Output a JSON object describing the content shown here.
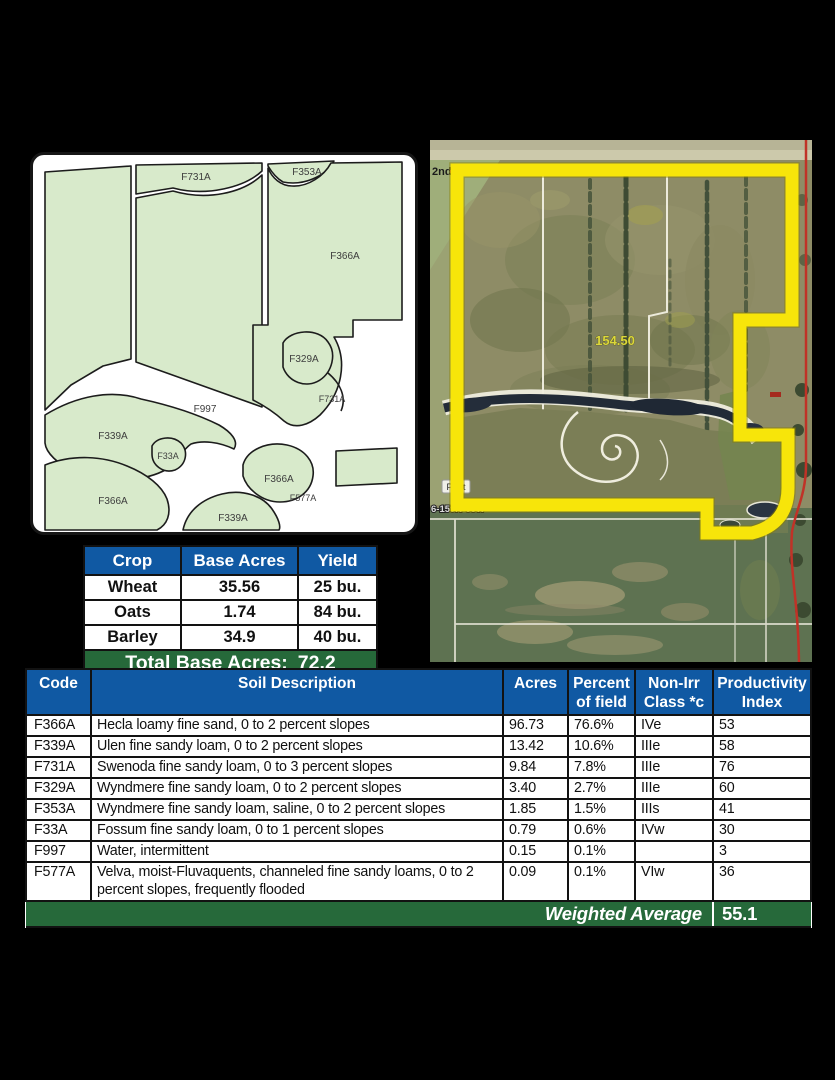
{
  "colors": {
    "header_blue": "#1059A3",
    "footer_green": "#26693A",
    "map_field_green": "#D8EACB",
    "boundary_yellow": "#F7E50A"
  },
  "soil_map": {
    "labels": [
      {
        "text": "F731A"
      },
      {
        "text": "F353A"
      },
      {
        "text": "F366A"
      },
      {
        "text": "F329A"
      },
      {
        "text": "F731A"
      },
      {
        "text": "F997"
      },
      {
        "text": "F339A"
      },
      {
        "text": "F33A"
      },
      {
        "text": "F366A"
      },
      {
        "text": "F366A"
      },
      {
        "text": "F577A"
      },
      {
        "text": "F339A"
      }
    ]
  },
  "aerial": {
    "road_label_left": "2nd",
    "road_label_right": "82nd St N",
    "acreage_label": "154.50",
    "place_label": "Pratt",
    "township_label": "6-159N-65W"
  },
  "crop_table": {
    "headers": [
      "Crop",
      "Base Acres",
      "Yield"
    ],
    "rows": [
      [
        "Wheat",
        "35.56",
        "25 bu."
      ],
      [
        "Oats",
        "1.74",
        "84 bu."
      ],
      [
        "Barley",
        "34.9",
        "40 bu."
      ]
    ],
    "total_label": "Total Base Acres:",
    "total_value": "72.2"
  },
  "soil_table": {
    "headers": [
      "Code",
      "Soil Description",
      "Acres",
      "Percent\nof field",
      "Non-Irr\nClass *c",
      "Productivity\nIndex"
    ],
    "rows": [
      [
        "F366A",
        "Hecla loamy fine sand, 0 to 2 percent slopes",
        "96.73",
        "76.6%",
        "IVe",
        "53"
      ],
      [
        "F339A",
        "Ulen fine sandy loam, 0 to 2 percent slopes",
        "13.42",
        "10.6%",
        "IIIe",
        "58"
      ],
      [
        "F731A",
        "Swenoda fine sandy loam, 0 to 3 percent slopes",
        "9.84",
        "7.8%",
        "IIIe",
        "76"
      ],
      [
        "F329A",
        "Wyndmere fine sandy loam, 0 to 2 percent slopes",
        "3.40",
        "2.7%",
        "IIIe",
        "60"
      ],
      [
        "F353A",
        "Wyndmere fine sandy loam, saline, 0 to 2 percent slopes",
        "1.85",
        "1.5%",
        "IIIs",
        "41"
      ],
      [
        "F33A",
        "Fossum fine sandy loam, 0 to 1 percent slopes",
        "0.79",
        "0.6%",
        "IVw",
        "30"
      ],
      [
        "F997",
        "Water, intermittent",
        "0.15",
        "0.1%",
        "",
        "3"
      ],
      [
        "F577A",
        "Velva, moist-Fluvaquents, channeled fine sandy loams, 0 to 2 percent slopes, frequently flooded",
        "0.09",
        "0.1%",
        "VIw",
        "36"
      ]
    ],
    "footer_label": "Weighted Average",
    "footer_value": "55.1"
  }
}
